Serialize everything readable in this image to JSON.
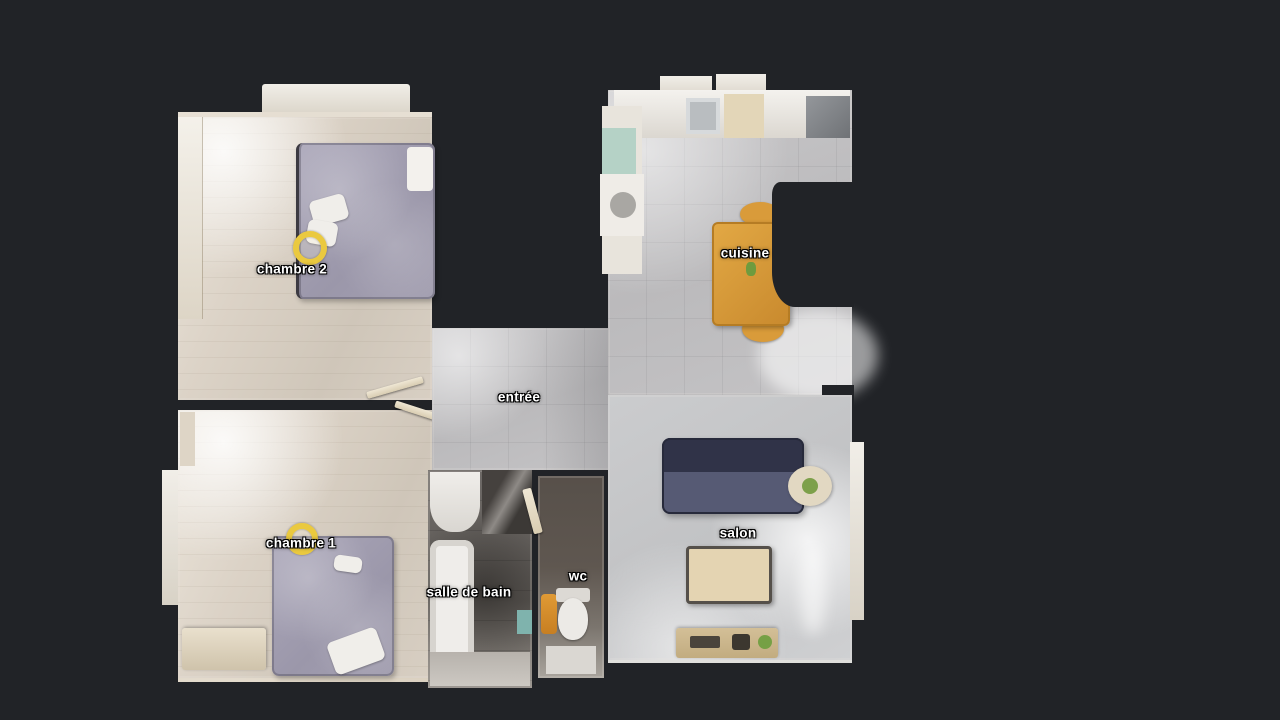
{
  "view": {
    "background_color": "#212327",
    "marker_color": "#eac93f"
  },
  "rooms": [
    {
      "id": "chambre-2",
      "label": "chambre 2"
    },
    {
      "id": "chambre-1",
      "label": "chambre 1"
    },
    {
      "id": "entree",
      "label": "entrée"
    },
    {
      "id": "salle-de-bain",
      "label": "salle de bain"
    },
    {
      "id": "wc",
      "label": "wc"
    },
    {
      "id": "cuisine",
      "label": "cuisine"
    },
    {
      "id": "salon",
      "label": "salon"
    }
  ]
}
